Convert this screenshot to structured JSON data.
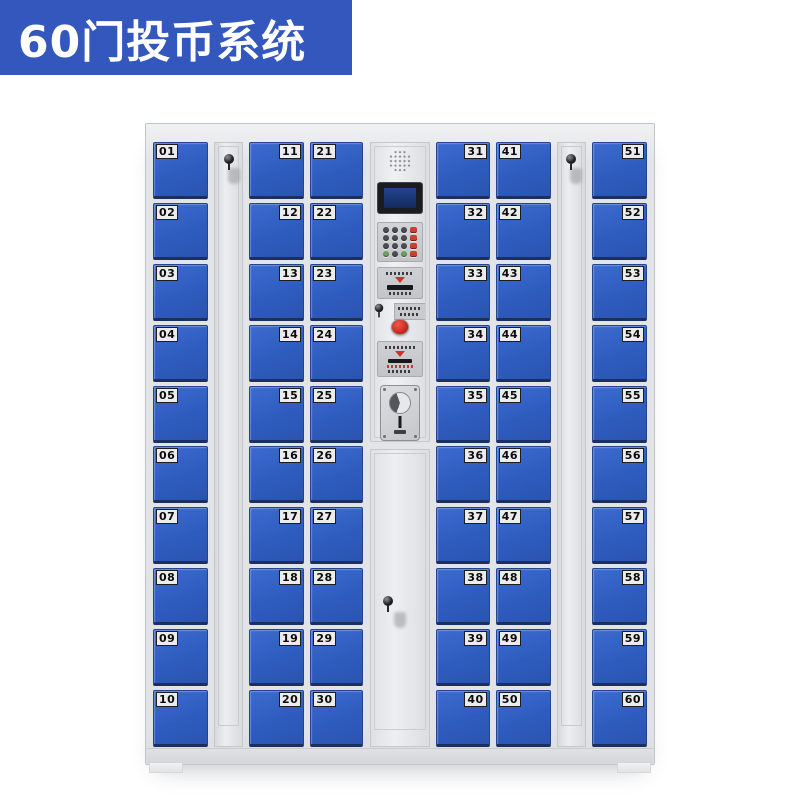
{
  "banner": {
    "title": "60门投币系统"
  },
  "colors": {
    "banner_bg": "#3457BE",
    "door_blue": "#2E5CBE",
    "cabinet_body": "#E3E4E7",
    "accent_red": "#D3302A"
  },
  "cabinet": {
    "columns": [
      {
        "kind": "doors",
        "width": 55,
        "label_side": "left",
        "doors": [
          "01",
          "02",
          "03",
          "04",
          "05",
          "06",
          "07",
          "08",
          "09",
          "10"
        ]
      },
      {
        "kind": "side-lock-panel",
        "width": 29
      },
      {
        "kind": "doors",
        "width": 55,
        "label_side": "right",
        "doors": [
          "11",
          "12",
          "13",
          "14",
          "15",
          "16",
          "17",
          "18",
          "19",
          "20"
        ]
      },
      {
        "kind": "doors",
        "width": 53,
        "label_side": "left",
        "doors": [
          "21",
          "22",
          "23",
          "24",
          "25",
          "26",
          "27",
          "28",
          "29",
          "30"
        ]
      },
      {
        "kind": "control",
        "width": 60,
        "components": [
          "speaker-grille",
          "lcd-display",
          "numeric-keypad",
          "card-reader-slot",
          "service-key-lock",
          "red-return-button",
          "instruction-plate",
          "coin-acceptor",
          "service-door"
        ]
      },
      {
        "kind": "doors",
        "width": 54,
        "label_side": "right",
        "doors": [
          "31",
          "32",
          "33",
          "34",
          "35",
          "36",
          "37",
          "38",
          "39",
          "40"
        ]
      },
      {
        "kind": "doors",
        "width": 55,
        "label_side": "left",
        "doors": [
          "41",
          "42",
          "43",
          "44",
          "45",
          "46",
          "47",
          "48",
          "49",
          "50"
        ]
      },
      {
        "kind": "side-lock-panel",
        "width": 29
      },
      {
        "kind": "doors",
        "width": 55,
        "label_side": "right",
        "doors": [
          "51",
          "52",
          "53",
          "54",
          "55",
          "56",
          "57",
          "58",
          "59",
          "60"
        ]
      }
    ]
  }
}
